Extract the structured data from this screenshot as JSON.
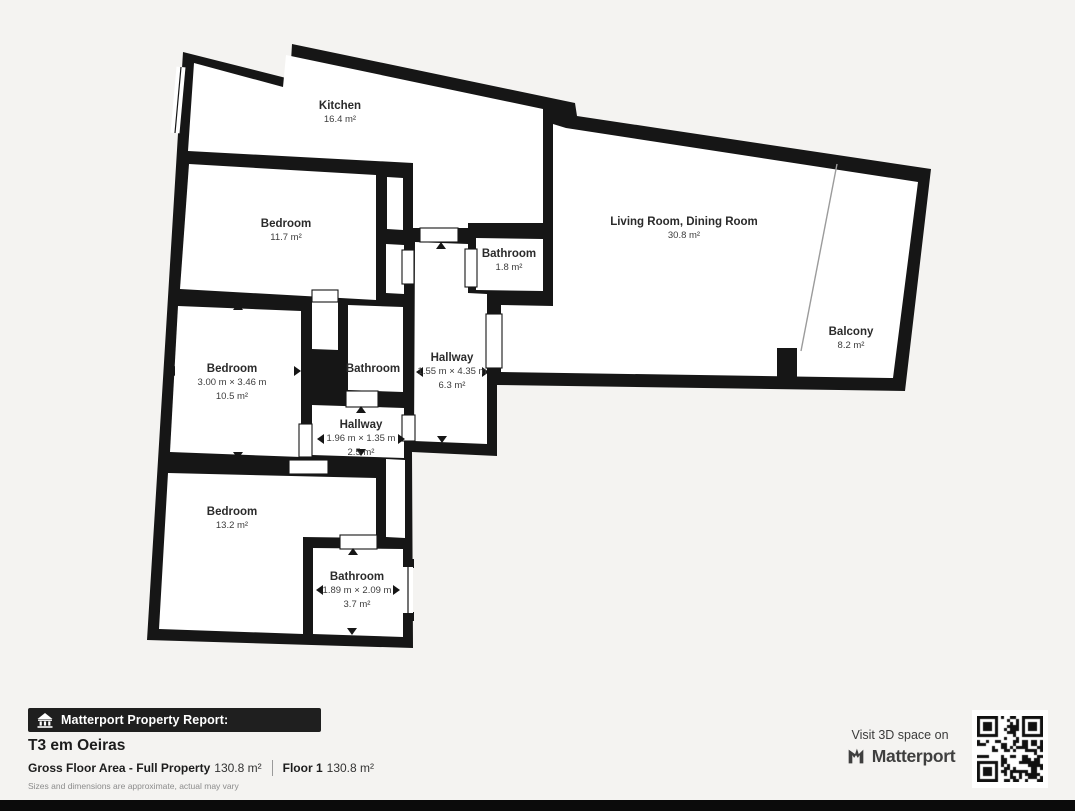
{
  "plan": {
    "rooms": [
      {
        "name": "Kitchen",
        "area": "16.4 m²"
      },
      {
        "name": "Bedroom",
        "area": "11.7 m²"
      },
      {
        "name": "Bathroom",
        "area": "1.8 m²"
      },
      {
        "name": "Living Room, Dining Room",
        "area": "30.8 m²"
      },
      {
        "name": "Balcony",
        "area": "8.2 m²"
      },
      {
        "name": "Bedroom",
        "dims": "3.00 m × 3.46 m",
        "area": "10.5 m²"
      },
      {
        "name": "Bathroom"
      },
      {
        "name": "Hallway",
        "dims": "1.55 m × 4.35 m",
        "area": "6.3 m²"
      },
      {
        "name": "Hallway",
        "dims": "1.96 m × 1.35 m",
        "area": "2.5 m²"
      },
      {
        "name": "Bedroom",
        "area": "13.2 m²"
      },
      {
        "name": "Bathroom",
        "dims": "1.89 m × 2.09 m",
        "area": "3.7 m²"
      }
    ]
  },
  "footer": {
    "report_badge": "Matterport Property Report:",
    "property_title": "T3 em Oeiras",
    "gross_label": "Gross Floor Area - Full Property",
    "gross_value": "130.8 m²",
    "floor_label": "Floor 1",
    "floor_value": "130.8 m²",
    "disclaimer": "Sizes and dimensions are approximate, actual may vary",
    "visit_text": "Visit 3D space on",
    "brand": "Matterport"
  },
  "colors": {
    "wall": "#161616",
    "background": "#f4f3f1",
    "room_fill": "#ffffff",
    "banner_bg": "#1f1f1f",
    "divider_line": "#9b9b9b"
  }
}
